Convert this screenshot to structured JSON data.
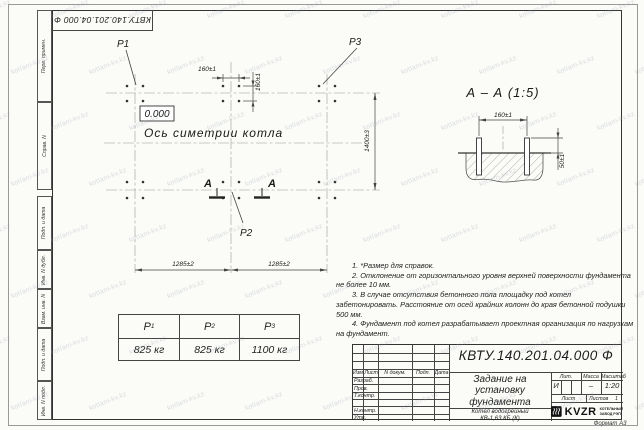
{
  "watermark": {
    "text": "kotlam-kv.kz"
  },
  "stamp_corner": {
    "doc_number": "КВТУ.140.201.04.000 Ф"
  },
  "frame_strip": {
    "labels": [
      "Перв. примен.",
      "Справ. N",
      "Подп. и дата",
      "Инв. N дубл.",
      "Взам. инв. N",
      "Подп. и дата",
      "Инв. N подл."
    ]
  },
  "plan": {
    "p1": "P1",
    "p2": "P2",
    "p3": "P3",
    "elevation": "0.000",
    "symmetry_axis_label": "Ось симетрии котла",
    "bolt_spacing_x": "160±1",
    "bolt_spacing_y": "160±1",
    "span_left": "1285±2",
    "span_right": "1285±2",
    "row_spacing": "1400±3",
    "section_letter_left": "А",
    "section_letter_right": "А"
  },
  "section_view": {
    "title": "А – А (1:5)",
    "bolt_spacing": "160±1",
    "protrusion": "50±1"
  },
  "loads_table": {
    "headers": [
      {
        "name": "P",
        "index": "1"
      },
      {
        "name": "P",
        "index": "2"
      },
      {
        "name": "P",
        "index": "3"
      }
    ],
    "values": [
      "825 кг",
      "825 кг",
      "1100 кг"
    ]
  },
  "notes": {
    "n1": "1. *Размер для справок.",
    "n2": "2. Отклонение от горизонтального уровня верхней поверхности фундамента не более 10 мм.",
    "n3": "3. В случае отсутствия бетонного пола площадку под котел забетонировать. Расстояние от осей крайних колонн до края бетонной подушки 500 мм.",
    "n4": "4. Фундамент под котел разрабатывает проектная организация по нагрузкам на фундамент."
  },
  "title_block": {
    "doc_number": "КВТУ.140.201.04.000 Ф",
    "title": "Задание на установку фундамента",
    "product_line1": "Котел водогрейный",
    "product_line2": "КВ-1,63 КБ (К)",
    "header_cols": [
      "Изм.Лист",
      "N докум.",
      "Подп.",
      "Дата"
    ],
    "rows": [
      "Разраб.",
      "Пров.",
      "Т.контр.",
      "Н.контр.",
      "Утв."
    ],
    "lit_header": "Лит.",
    "mass_header": "Масса",
    "scale_header": "Масштаб",
    "lit_value": "И",
    "mass_value": "–",
    "scale_value": "1:20",
    "sheet_label": "Лист",
    "sheets_label": "Листов",
    "sheets_value": "1",
    "company": {
      "logo_text": "KVZR",
      "tagline1": "КОТЕЛЬНЫЙ",
      "tagline2": "ЗАВОД РЭП"
    },
    "format_note": "Формат А3"
  }
}
